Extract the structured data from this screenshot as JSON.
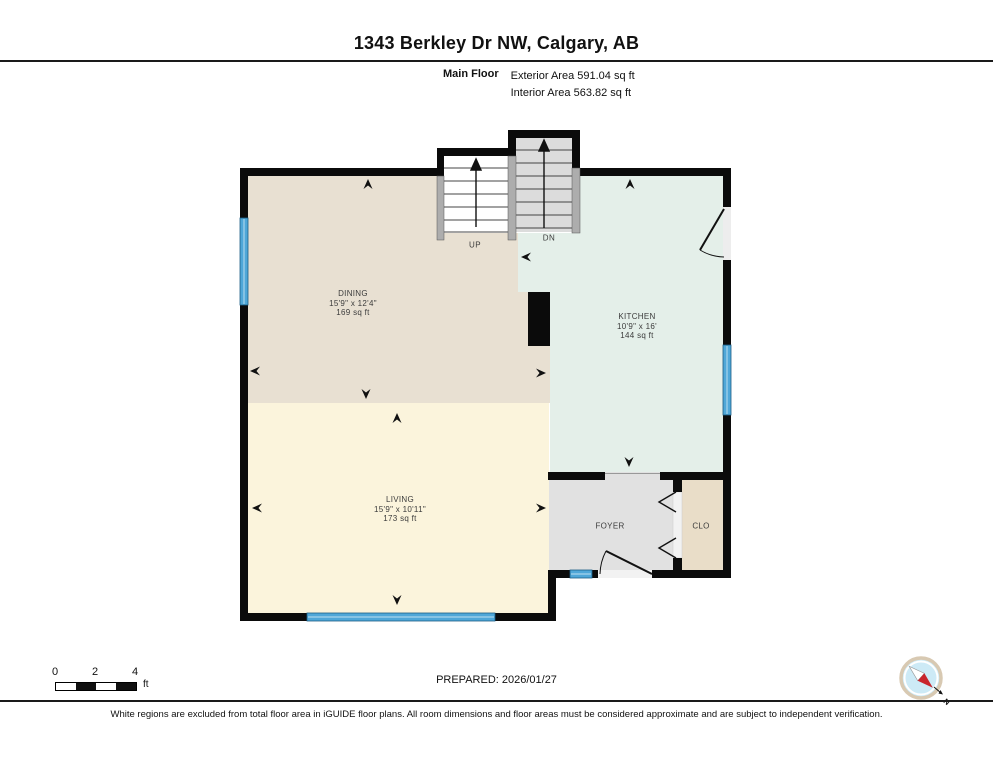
{
  "header": {
    "title": "1343 Berkley Dr NW, Calgary, AB",
    "floor_label": "Main Floor",
    "exterior_area": "Exterior Area 591.04 sq ft",
    "interior_area": "Interior Area 563.82 sq ft"
  },
  "floor_plan": {
    "rooms": [
      {
        "name": "DINING",
        "dimensions": "15'9\" x 12'4\"",
        "area": "169 sq ft"
      },
      {
        "name": "KITCHEN",
        "dimensions": "10'9\" x 16'",
        "area": "144 sq ft"
      },
      {
        "name": "LIVING",
        "dimensions": "15'9\" x 10'11\"",
        "area": "173 sq ft"
      },
      {
        "name": "FOYER"
      },
      {
        "name": "CLO"
      }
    ],
    "stairs": {
      "up_label": "UP",
      "down_label": "DN"
    }
  },
  "footer": {
    "scale": {
      "ticks": [
        "0",
        "2",
        "4"
      ],
      "unit": "ft"
    },
    "prepared": "PREPARED: 2026/01/27",
    "compass": {
      "label": "N"
    },
    "disclaimer": "White regions are excluded from total floor area in iGUIDE floor plans. All room dimensions and floor areas must be considered approximate and are subject to independent verification."
  },
  "colors": {
    "wall": "#0b0b0b",
    "window": "#4fa7d8",
    "dining_floor": "#e8e0d2",
    "kitchen_floor": "#e4efe9",
    "living_floor": "#fbf4dc",
    "foyer_floor": "#e1e1e1",
    "closet_floor": "#e9ddc8",
    "stair_down_fill": "#dcdcdc",
    "railing": "#adadad",
    "compass_ring": "#d8c9b2",
    "compass_face": "#cdeaf6",
    "compass_needle_north": "#c9252c",
    "compass_needle_south": "#ffffff"
  }
}
